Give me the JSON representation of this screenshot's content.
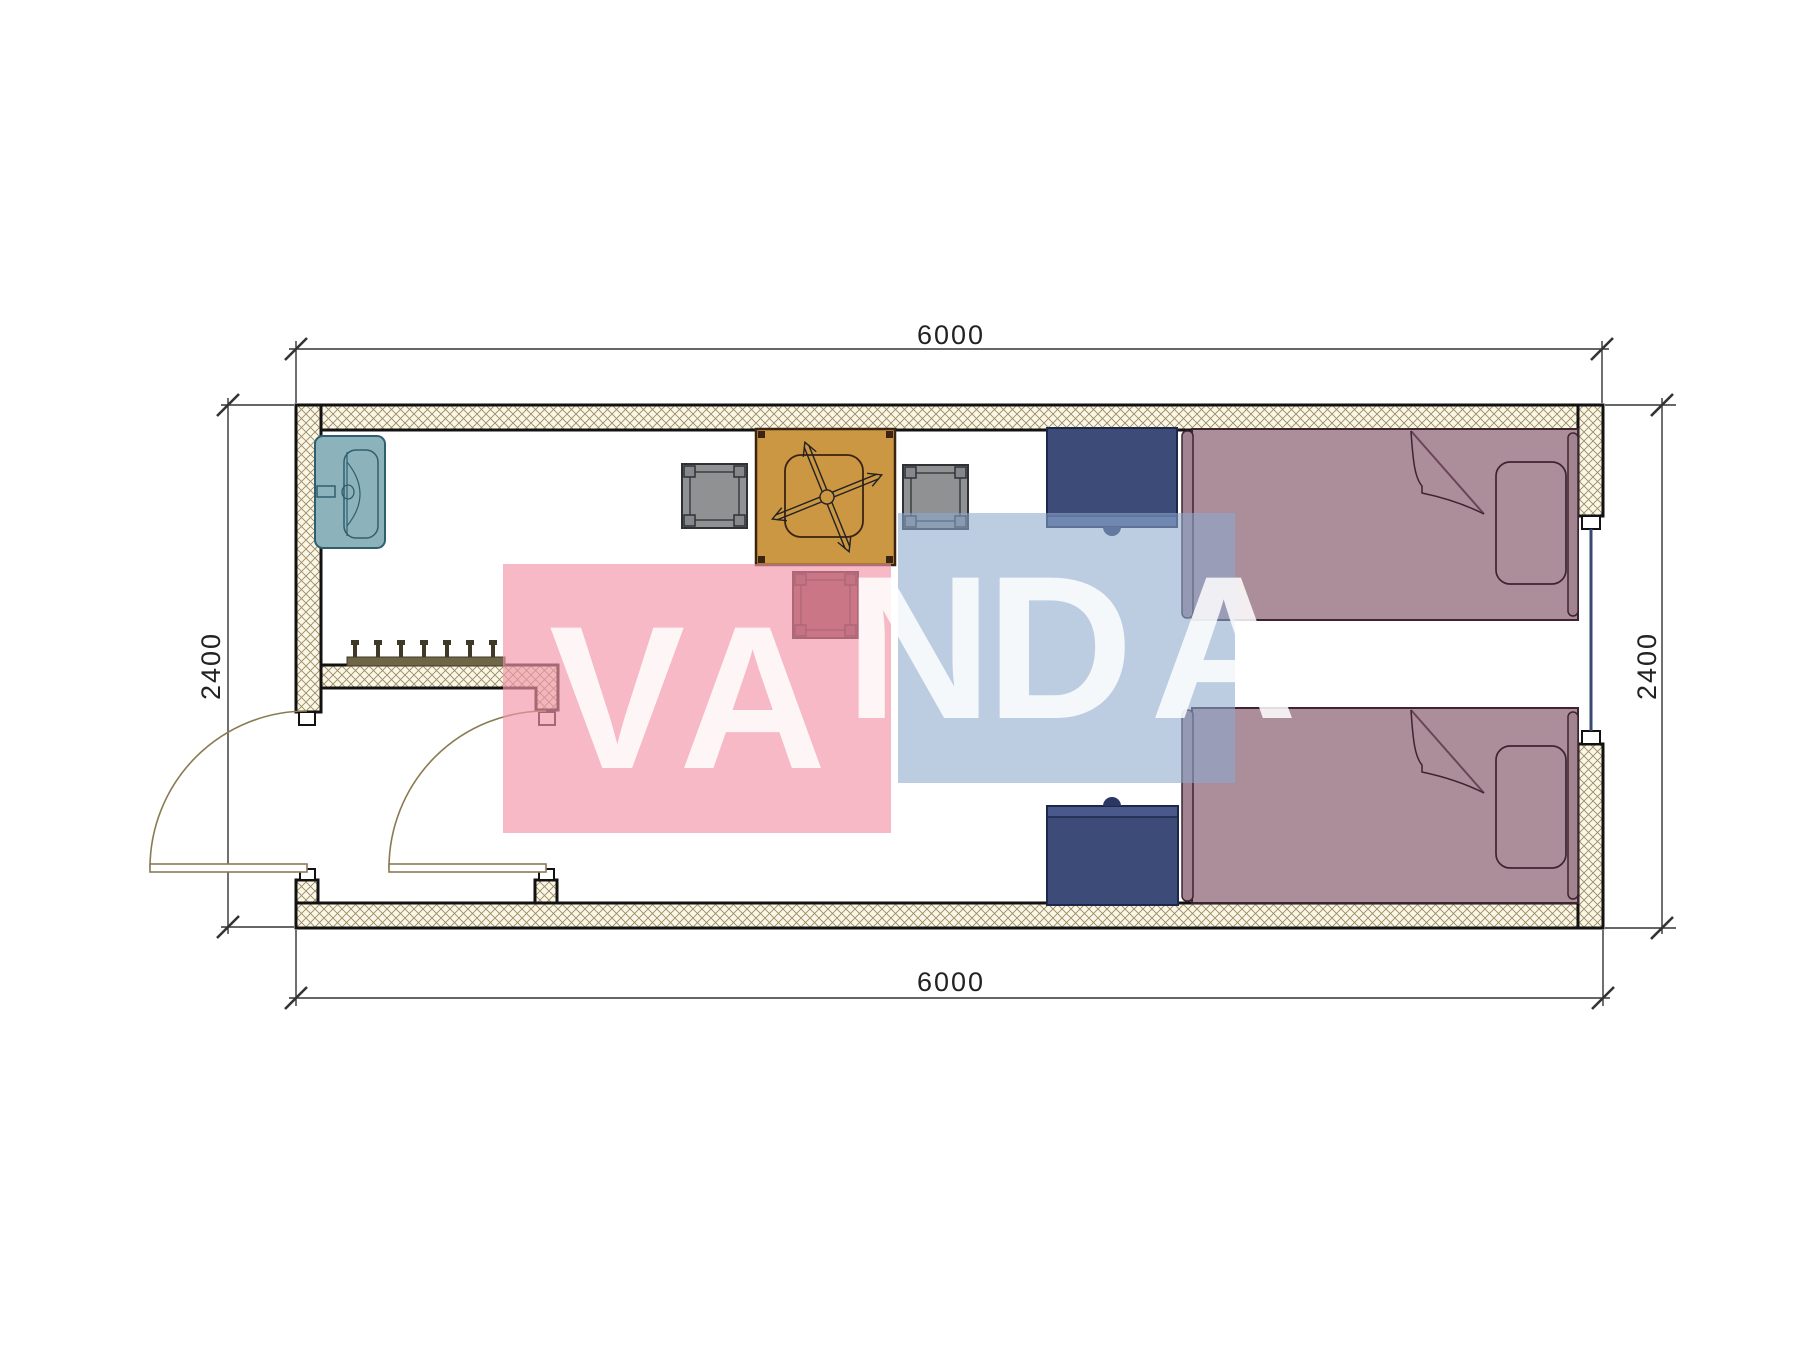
{
  "watermark": {
    "text": "VANDA",
    "letters": [
      "V",
      "A",
      "N",
      "D",
      "A"
    ],
    "pink_box_color": "#F294A7",
    "blue_box_color": "#8CA8CD",
    "letter_color": "#FFFFFF"
  },
  "dimensions": {
    "width_top": "6000",
    "width_bottom": "6000",
    "height_left": "2400",
    "height_right": "2400"
  },
  "plan": {
    "type": "floor-plan",
    "furniture": [
      {
        "name": "sink",
        "color": "#8CB3BC"
      },
      {
        "name": "square-table-with-fan-symbol",
        "color": "#CB9743"
      },
      {
        "name": "chair-left",
        "color": "#8F9192"
      },
      {
        "name": "chair-right",
        "color": "#8F9192"
      },
      {
        "name": "chair-bottom",
        "color": "#7E3D49"
      },
      {
        "name": "nightstand-top",
        "color": "#3D4B79"
      },
      {
        "name": "nightstand-bottom",
        "color": "#3D4B79"
      },
      {
        "name": "bed-top",
        "color": "#AC8E9A"
      },
      {
        "name": "bed-bottom",
        "color": "#AC8E9A"
      },
      {
        "name": "coat-hooks",
        "color": "#6F6547"
      },
      {
        "name": "entry-door-swing",
        "color": "#8A7A52"
      },
      {
        "name": "interior-door-swing",
        "color": "#8A7A52"
      },
      {
        "name": "window",
        "color": "#3A4874"
      }
    ],
    "colors": {
      "wall_fill": "#FAF6E8",
      "wall_hatch": "#9A8B60",
      "wall_outline": "#121212",
      "dimension_line": "#333333"
    }
  }
}
